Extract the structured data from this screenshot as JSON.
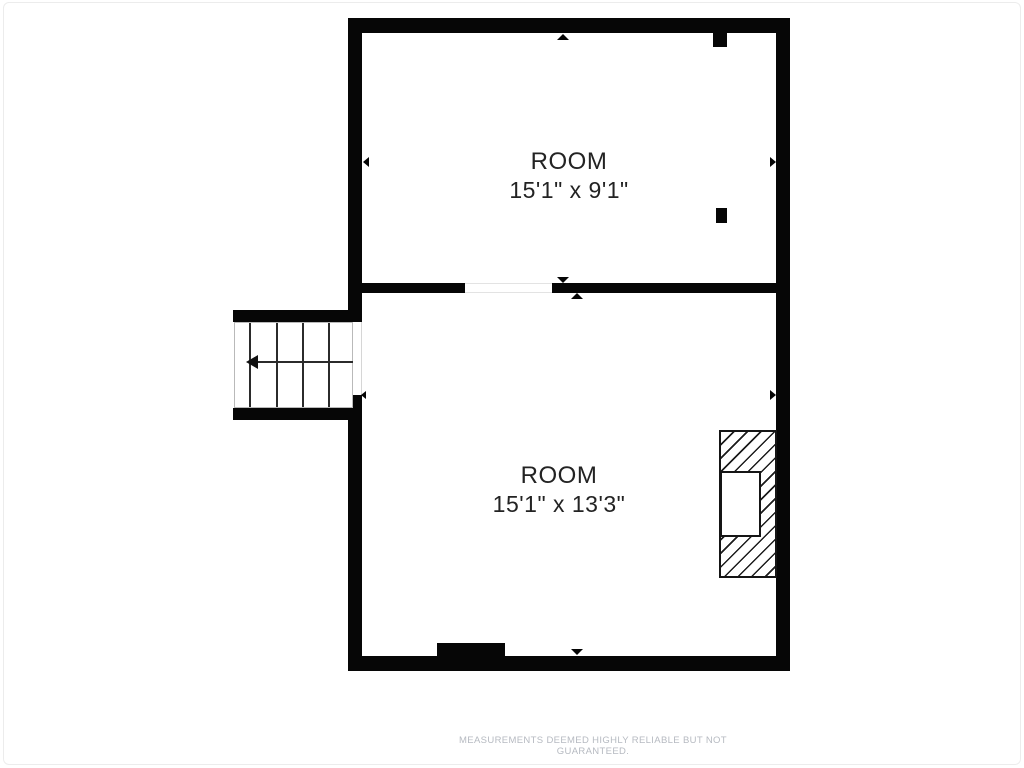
{
  "floorplan": {
    "rooms": [
      {
        "label": "ROOM",
        "dimensions": "15'1\" x 9'1\""
      },
      {
        "label": "ROOM",
        "dimensions": "15'1\" x 13'3\""
      }
    ],
    "disclaimer": "MEASUREMENTS DEEMED HIGHLY RELIABLE BUT NOT GUARANTEED.",
    "colors": {
      "wall": "#060606",
      "label_text": "#232323",
      "disclaimer_text": "#b6bac1"
    }
  }
}
